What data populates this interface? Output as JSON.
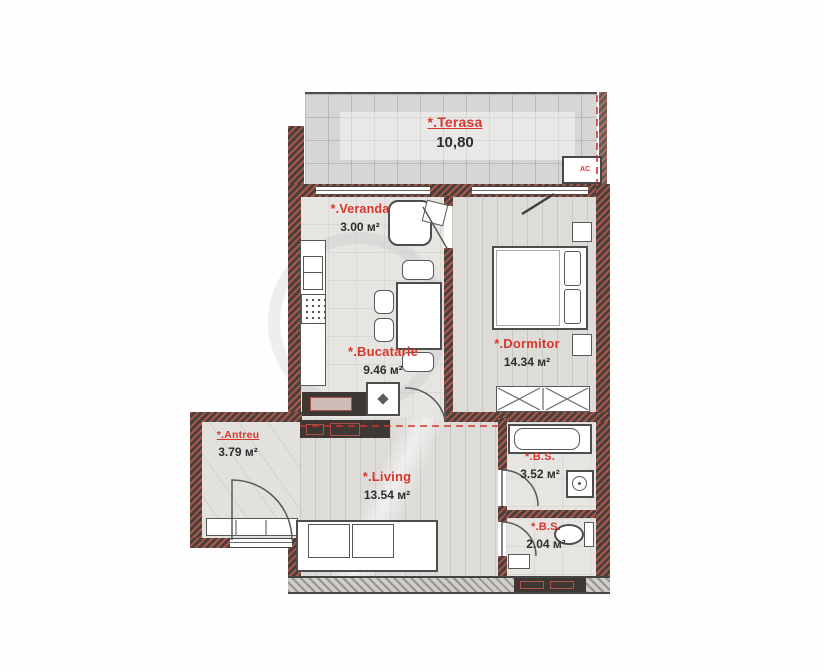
{
  "plan": {
    "rooms": {
      "terasa": {
        "label": "*.Terasa",
        "area": "10,80"
      },
      "veranda": {
        "label": "*.Veranda",
        "area": "3.00 м²"
      },
      "bucatarie": {
        "label": "*.Bucatarie",
        "area": "9.46 м²"
      },
      "dormitor": {
        "label": "*.Dormitor",
        "area": "14.34 м²"
      },
      "antreu": {
        "label": "*.Antreu",
        "area": "3.79 м²"
      },
      "living": {
        "label": "*.Living",
        "area": "13.54 м²"
      },
      "bs1": {
        "label": "*.B.S.",
        "area": "3.52 м²"
      },
      "bs2": {
        "label": "*.B.S.",
        "area": "2.04 м²"
      }
    },
    "annotations": {
      "ac": "AC"
    },
    "colors": {
      "label_red": "#d8362c",
      "wall": "#4a403b",
      "area_text": "#2e2e2e"
    }
  }
}
